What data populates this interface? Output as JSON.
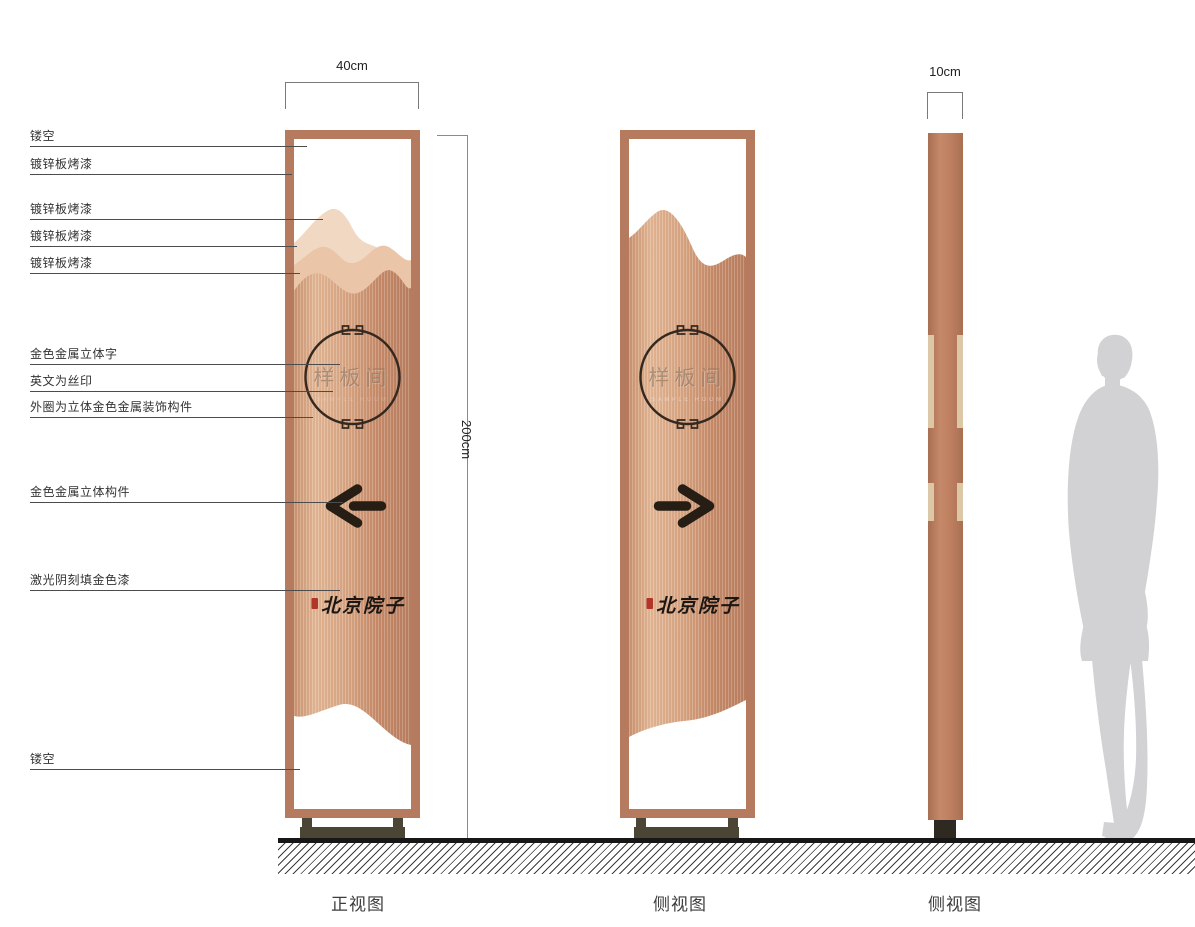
{
  "title": "signage-design-drawing",
  "annotations": [
    {
      "label": "镂空"
    },
    {
      "label": "镀锌板烤漆"
    },
    {
      "label": "镀锌板烤漆"
    },
    {
      "label": "镀锌板烤漆"
    },
    {
      "label": "镀锌板烤漆"
    },
    {
      "label": "金色金属立体字"
    },
    {
      "label": "英文为丝印"
    },
    {
      "label": "外圈为立体金色金属装饰构件"
    },
    {
      "label": "金色金属立体构件"
    },
    {
      "label": "激光阴刻填金色漆"
    },
    {
      "label": "镂空"
    }
  ],
  "dimensions": {
    "front_width": "40cm",
    "height": "200cm",
    "side_depth": "10cm"
  },
  "signs": {
    "front": {
      "circle_text": "样板间",
      "english_text": "SAMPLE ROOM",
      "brand_text": "北京院子",
      "arrow_direction": "left"
    },
    "side_a": {
      "circle_text": "样板间",
      "english_text": "SAMPLE ROOM",
      "brand_text": "北京院子",
      "arrow_direction": "right"
    }
  },
  "view_labels": [
    {
      "label": "正视图"
    },
    {
      "label": "侧视图"
    },
    {
      "label": "侧视图"
    }
  ],
  "colors": {
    "frame_copper": "#b67a5e",
    "body_copper_light": "#e2b694",
    "body_copper_dark": "#b87e5f",
    "ornament_dark": "#35281f",
    "metal_strip_tan": "#dcc7a6",
    "base_olive": "#4a4535",
    "seal_red": "#b23527",
    "silhouette_gray": "#d2d2d4"
  }
}
